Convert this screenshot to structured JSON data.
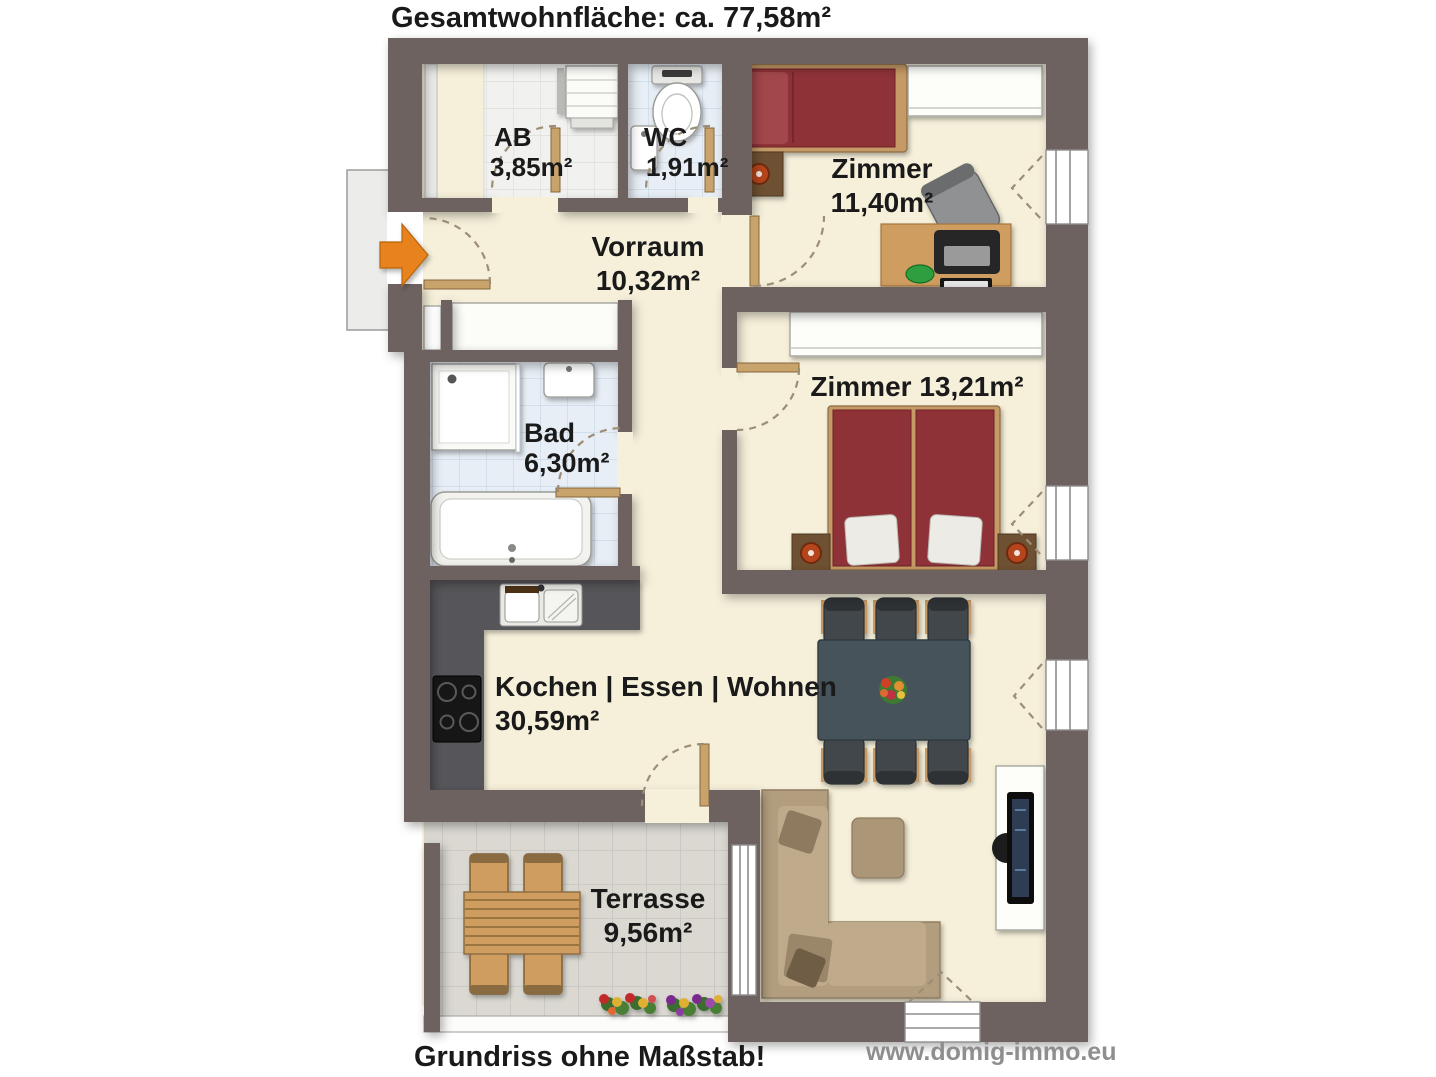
{
  "title": "Gesamtwohnfläche: ca. 77,58m²",
  "footer": {
    "disclaimer": "Grundriss ohne Maßstab!",
    "watermark": "www.domig-immo.eu"
  },
  "rooms": {
    "ab": {
      "name": "AB",
      "area": "3,85m²"
    },
    "wc": {
      "name": "WC",
      "area": "1,91m²"
    },
    "vorraum": {
      "name": "Vorraum",
      "area": "10,32m²"
    },
    "zimmer_klein": {
      "name": "Zimmer",
      "area": "11,40m²"
    },
    "zimmer_gross": {
      "label": "Zimmer 13,21m²"
    },
    "bad": {
      "name": "Bad",
      "area": "6,30m²"
    },
    "wohnbereich": {
      "name": "Kochen | Essen | Wohnen",
      "area": "30,59m²"
    },
    "terrasse": {
      "name": "Terrasse",
      "area": "9,56m²"
    }
  },
  "icons": {
    "entrance_arrow": "entrance-arrow"
  },
  "colors": {
    "wall": "#6E6260",
    "floor": "#F6F0DA",
    "tile_bath": "#E7EEF5",
    "tile_storage": "#F1F1EF",
    "tile_terrace": "#DAD8D1",
    "entrance_arrow": "#E8821C",
    "bed": "#8E3338",
    "wood": "#CF9D5F",
    "dining_table": "#46525A",
    "sofa": "#B29D7F",
    "kitchen_counter": "#57575A"
  }
}
